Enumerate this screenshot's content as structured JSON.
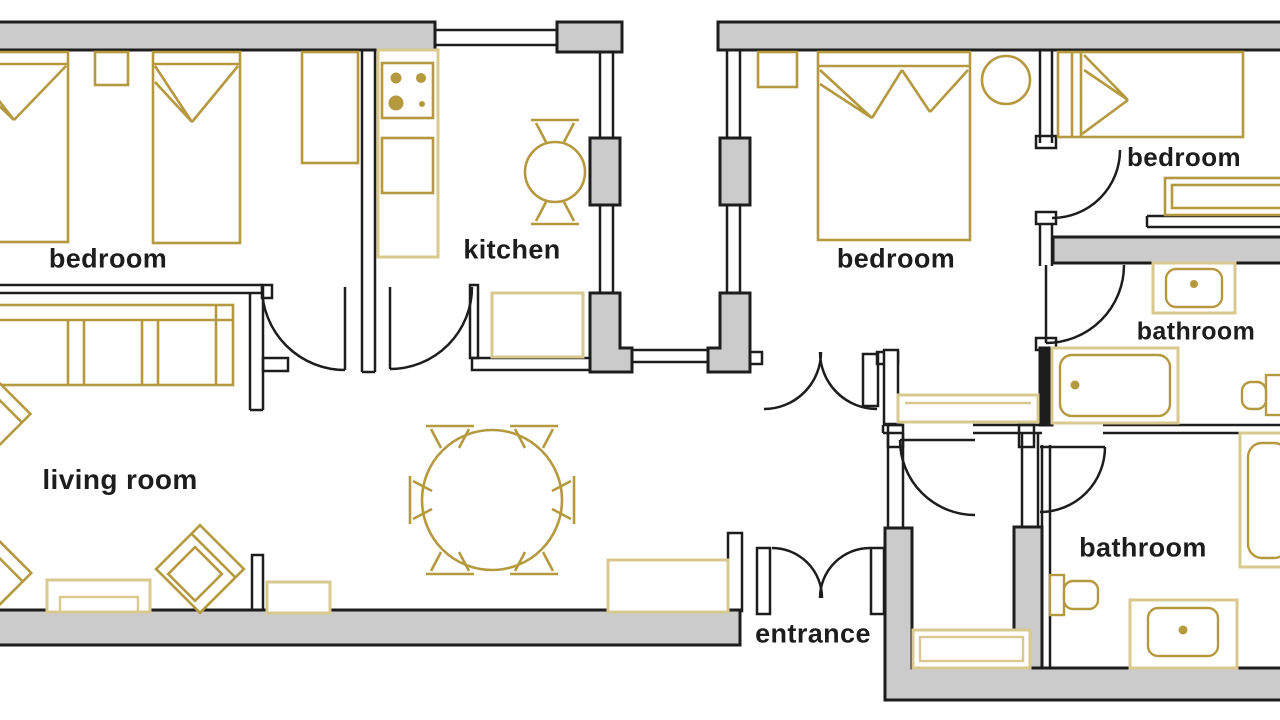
{
  "plan": {
    "type": "apartment-floor-plan",
    "colors": {
      "background": "#ffffff",
      "wall_fill": "#cbcbcb",
      "outline": "#1d1d1d",
      "furniture_gold": "#b5993f",
      "furniture_pale": "#d9c98f"
    },
    "labels": {
      "bedroom_left": "bedroom",
      "kitchen": "kitchen",
      "bedroom_middle": "bedroom",
      "bedroom_right": "bedroom",
      "bathroom_top": "bathroom",
      "living_room": "living room",
      "entrance": "entrance",
      "bathroom_bottom": "bathroom"
    },
    "furniture": [
      "single-bed",
      "double-bed",
      "nightstand",
      "wardrobe",
      "stove",
      "kitchen-counter",
      "kitchen-table",
      "dining-table",
      "chair",
      "sofa",
      "armchair",
      "tv-stand",
      "sideboard",
      "bench",
      "bathtub",
      "shower",
      "toilet",
      "bathroom-sink",
      "round-chair"
    ]
  }
}
